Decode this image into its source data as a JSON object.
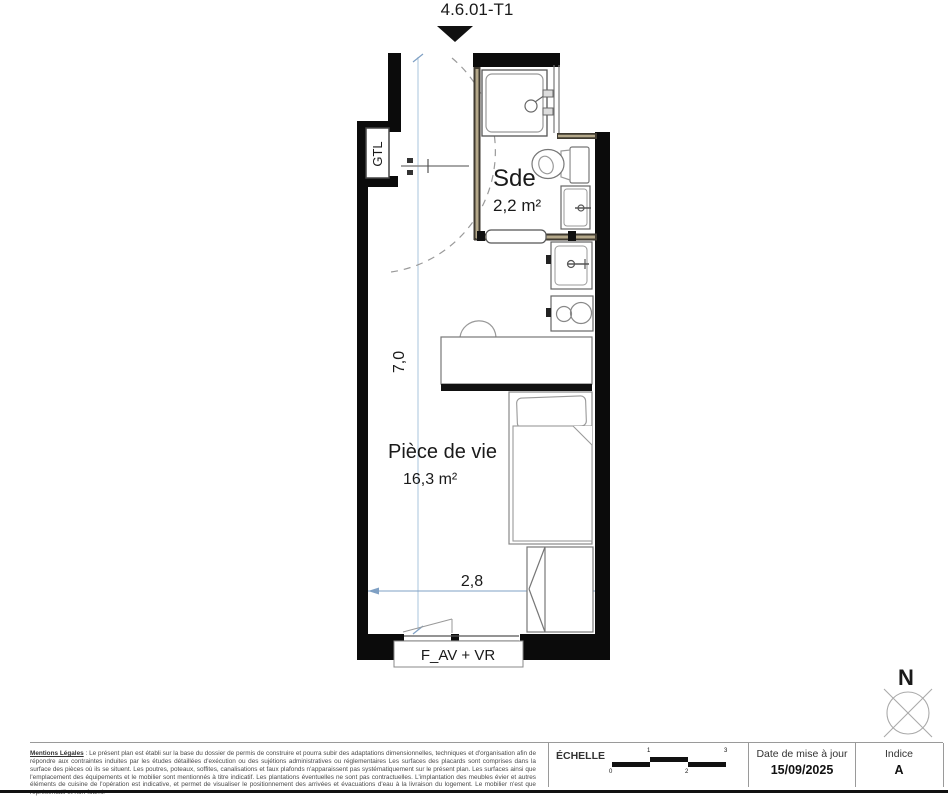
{
  "title": "4.6.01-T1",
  "plan": {
    "rooms": [
      {
        "name": "Sde",
        "area": "2,2 m²"
      },
      {
        "name": "Pièce de vie",
        "area": "16,3 m²"
      }
    ],
    "labels": {
      "gtl": "GTL",
      "window": "F_AV + VR"
    },
    "dimensions": {
      "height_label": "7,0",
      "width_label": "2,8"
    },
    "north_label": "N"
  },
  "colors": {
    "wall": "#0b0b0b",
    "dimension_line": "#7fa0c4",
    "dimension_text": "#2e4468",
    "furniture_line": "#909090"
  },
  "footer": {
    "legal_title": "Mentions Légales",
    "legal_body": " : Le présent plan est établi sur la base du dossier de permis de construire et pourra subir des adaptations dimensionnelles, techniques et d'organisation afin de répondre aux contraintes induites par les études détaillées d'exécution ou des sujétions administratives ou réglementaires Les surfaces des placards sont comprises dans la surface des pièces où ils se situent. Les poutres, poteaux, soffites, canalisations et faux plafonds n'apparaissent pas systématiquement sur le présent plan. Les surfaces ainsi que l'emplacement des équipements et le mobilier sont mentionnés à titre indicatif. Les plantations éventuelles ne sont pas contractuelles. L'implantation des meubles évier et autres éléments de cuisine de l'opération est indicative, et permet de visualiser le positionnement des arrivées et évacuations d'eau à la livraison du logement. Le mobilier n'est que représentatif et non-fourni.",
    "scale": {
      "label": "ÉCHELLE",
      "ticks": [
        "0",
        "1",
        "2",
        "3"
      ]
    },
    "update": {
      "label": "Date de mise à jour",
      "value": "15/09/2025"
    },
    "index": {
      "label": "Indice",
      "value": "A"
    }
  }
}
